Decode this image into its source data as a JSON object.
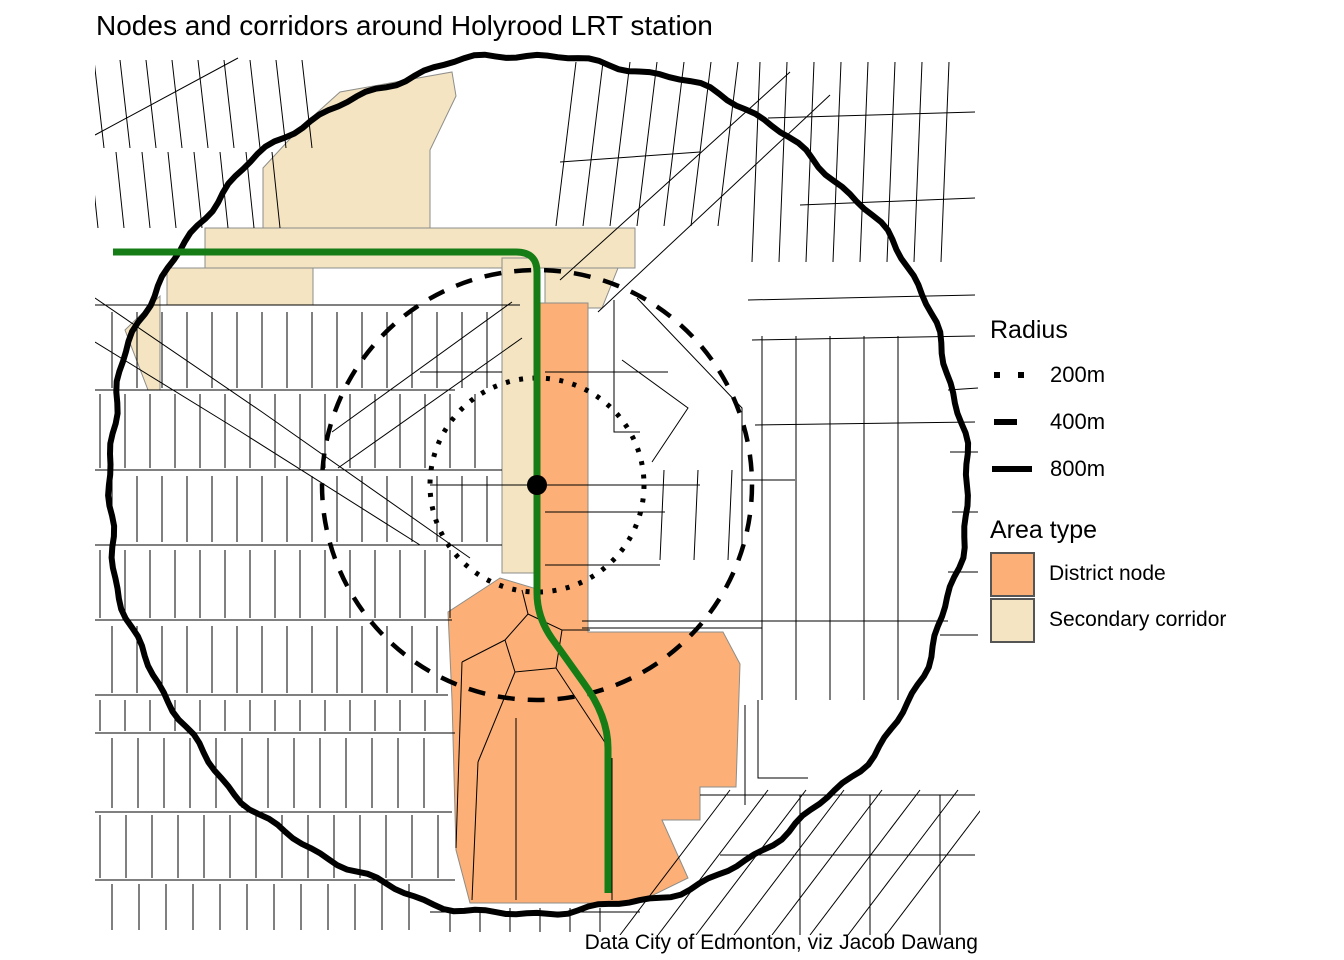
{
  "title": "Nodes and corridors around Holyrood LRT station",
  "caption": "Data City of Edmonton, viz Jacob Dawang",
  "legend_radius": {
    "title": "Radius",
    "items": [
      {
        "label": "200m",
        "style": "dotted"
      },
      {
        "label": "400m",
        "style": "dashed"
      },
      {
        "label": "800m",
        "style": "solid"
      }
    ]
  },
  "legend_area": {
    "title": "Area type",
    "items": [
      {
        "label": "District node",
        "color": "#FCAF76"
      },
      {
        "label": "Secondary corridor",
        "color": "#F4E4C2"
      }
    ]
  },
  "colors": {
    "street": "#000000",
    "district_node": "#FCAF76",
    "secondary_corridor": "#F4E4C2",
    "polygon_outline": "#8d8d89",
    "route_green": "#167D16",
    "ring_black": "#000000",
    "background": "#ffffff"
  },
  "map": {
    "extent": {
      "x": 95,
      "y": 50,
      "w": 885,
      "h": 885
    },
    "station": {
      "x": 537,
      "y": 485,
      "dot_radius": 10
    },
    "rings": [
      {
        "label": "200m",
        "r": 107,
        "style": "dotted",
        "width": 5
      },
      {
        "label": "400m",
        "r": 215,
        "style": "dashed",
        "width": 4.5
      },
      {
        "label": "800m",
        "r": 429,
        "style": "solid",
        "width": 6
      }
    ],
    "route_path": "M 113 252 L 516 252 Q 537 252 537 272 L 537 593 Q 537 618 553 640 L 583 682 Q 608 716 608 748 L 608 893",
    "route_width": 7,
    "corridor_polys": [
      [
        [
          263,
          168
        ],
        [
          300,
          128
        ],
        [
          340,
          92
        ],
        [
          452,
          72
        ],
        [
          456,
          96
        ],
        [
          430,
          150
        ],
        [
          430,
          232
        ],
        [
          263,
          232
        ]
      ],
      [
        [
          205,
          228
        ],
        [
          635,
          228
        ],
        [
          635,
          268
        ],
        [
          205,
          268
        ]
      ],
      [
        [
          167,
          268
        ],
        [
          313,
          268
        ],
        [
          313,
          305
        ],
        [
          167,
          305
        ]
      ],
      [
        [
          545,
          268
        ],
        [
          618,
          268
        ],
        [
          602,
          308
        ],
        [
          545,
          308
        ]
      ],
      [
        [
          125,
          330
        ],
        [
          160,
          296
        ],
        [
          160,
          390
        ],
        [
          148,
          390
        ]
      ],
      [
        [
          502,
          258
        ],
        [
          534,
          258
        ],
        [
          534,
          573
        ],
        [
          502,
          573
        ]
      ]
    ],
    "node_polys": [
      [
        [
          540,
          303
        ],
        [
          588,
          303
        ],
        [
          588,
          632
        ],
        [
          723,
          632
        ],
        [
          740,
          664
        ],
        [
          736,
          787
        ],
        [
          700,
          787
        ],
        [
          700,
          820
        ],
        [
          662,
          820
        ],
        [
          688,
          878
        ],
        [
          637,
          903
        ],
        [
          470,
          903
        ],
        [
          456,
          850
        ],
        [
          452,
          700
        ],
        [
          448,
          612
        ],
        [
          500,
          578
        ],
        [
          540,
          590
        ]
      ]
    ],
    "streets": {
      "lines": [
        [
          [
            95,
            305
          ],
          [
            520,
            305
          ]
        ],
        [
          [
            95,
            390
          ],
          [
            455,
            390
          ]
        ],
        [
          [
            95,
            470
          ],
          [
            502,
            470
          ]
        ],
        [
          [
            95,
            545
          ],
          [
            502,
            545
          ]
        ],
        [
          [
            95,
            620
          ],
          [
            452,
            620
          ]
        ],
        [
          [
            95,
            695
          ],
          [
            448,
            695
          ]
        ],
        [
          [
            95,
            733
          ],
          [
            455,
            733
          ]
        ],
        [
          [
            95,
            812
          ],
          [
            452,
            812
          ]
        ],
        [
          [
            95,
            880
          ],
          [
            455,
            880
          ]
        ],
        [
          [
            430,
            912
          ],
          [
            640,
            912
          ]
        ],
        [
          [
            420,
            372
          ],
          [
            502,
            372
          ]
        ],
        [
          [
            545,
            372
          ],
          [
            668,
            372
          ]
        ],
        [
          [
            430,
            485
          ],
          [
            535,
            485
          ]
        ],
        [
          [
            545,
            485
          ],
          [
            700,
            485
          ]
        ],
        [
          [
            545,
            512
          ],
          [
            665,
            512
          ]
        ],
        [
          [
            545,
            565
          ],
          [
            660,
            565
          ]
        ],
        [
          [
            582,
            621
          ],
          [
            948,
            621
          ]
        ],
        [
          [
            582,
            628
          ],
          [
            762,
            628
          ]
        ],
        [
          [
            560,
            280
          ],
          [
            790,
            72
          ]
        ],
        [
          [
            598,
            312
          ],
          [
            830,
            95
          ]
        ],
        [
          [
            332,
            432
          ],
          [
            512,
            302
          ]
        ],
        [
          [
            338,
            468
          ],
          [
            522,
            338
          ]
        ],
        [
          [
            95,
            298
          ],
          [
            262,
            412
          ],
          [
            470,
            558
          ]
        ],
        [
          [
            95,
            342
          ],
          [
            238,
            430
          ],
          [
            420,
            545
          ]
        ],
        [
          [
            238,
            58
          ],
          [
            95,
            135
          ]
        ],
        [
          [
            614,
            300
          ],
          [
            614,
            432
          ],
          [
            640,
            432
          ]
        ],
        [
          [
            622,
            360
          ],
          [
            688,
            408
          ],
          [
            652,
            462
          ]
        ],
        [
          [
            637,
            298
          ],
          [
            742,
            408
          ],
          [
            742,
            545
          ]
        ],
        [
          [
            742,
            480
          ],
          [
            795,
            480
          ]
        ],
        [
          [
            748,
            300
          ],
          [
            975,
            295
          ]
        ],
        [
          [
            752,
            340
          ],
          [
            975,
            336
          ]
        ],
        [
          [
            755,
            425
          ],
          [
            975,
            422
          ]
        ],
        [
          [
            948,
            390
          ],
          [
            978,
            388
          ]
        ],
        [
          [
            950,
            452
          ],
          [
            978,
            452
          ]
        ],
        [
          [
            952,
            512
          ],
          [
            978,
            512
          ]
        ],
        [
          [
            948,
            572
          ],
          [
            978,
            572
          ]
        ],
        [
          [
            940,
            635
          ],
          [
            978,
            635
          ]
        ],
        [
          [
            745,
            705
          ],
          [
            745,
            805
          ]
        ],
        [
          [
            758,
            700
          ],
          [
            758,
            778
          ],
          [
            808,
            778
          ]
        ],
        [
          [
            768,
            118
          ],
          [
            975,
            112
          ]
        ],
        [
          [
            800,
            205
          ],
          [
            975,
            198
          ]
        ],
        [
          [
            560,
            162
          ],
          [
            700,
            152
          ]
        ],
        [
          [
            700,
            795
          ],
          [
            975,
            795
          ]
        ],
        [
          [
            720,
            855
          ],
          [
            975,
            855
          ]
        ],
        [
          [
            800,
            795
          ],
          [
            800,
            935
          ]
        ],
        [
          [
            870,
            795
          ],
          [
            870,
            935
          ]
        ],
        [
          [
            940,
            795
          ],
          [
            940,
            935
          ]
        ],
        [
          [
            505,
            640
          ],
          [
            528,
            614
          ],
          [
            562,
            630
          ],
          [
            556,
            668
          ],
          [
            515,
            672
          ],
          [
            505,
            640
          ]
        ],
        [
          [
            505,
            640
          ],
          [
            462,
            662
          ]
        ],
        [
          [
            515,
            672
          ],
          [
            478,
            762
          ]
        ],
        [
          [
            478,
            762
          ],
          [
            472,
            900
          ]
        ],
        [
          [
            556,
            668
          ],
          [
            606,
            744
          ]
        ],
        [
          [
            528,
            614
          ],
          [
            522,
            590
          ]
        ],
        [
          [
            562,
            630
          ],
          [
            590,
            630
          ]
        ],
        [
          [
            516,
            718
          ],
          [
            516,
            900
          ]
        ],
        [
          [
            612,
            758
          ],
          [
            612,
            900
          ]
        ],
        [
          [
            462,
            662
          ],
          [
            456,
            848
          ]
        ]
      ],
      "combs": [
        {
          "x0": 104,
          "x1": 330,
          "step": 26,
          "y0": 60,
          "y1": 148,
          "skew": -10
        },
        {
          "x0": 98,
          "x1": 300,
          "step": 26,
          "y0": 152,
          "y1": 228,
          "skew": -8
        },
        {
          "x0": 112,
          "x1": 498,
          "step": 25,
          "y0": 312,
          "y1": 388,
          "skew": 0
        },
        {
          "x0": 100,
          "x1": 498,
          "step": 25,
          "y0": 394,
          "y1": 468,
          "skew": 0
        },
        {
          "x0": 112,
          "x1": 498,
          "step": 25,
          "y0": 476,
          "y1": 542,
          "skew": 0
        },
        {
          "x0": 100,
          "x1": 470,
          "step": 25,
          "y0": 550,
          "y1": 618,
          "skew": 0
        },
        {
          "x0": 112,
          "x1": 445,
          "step": 25,
          "y0": 626,
          "y1": 693,
          "skew": 0
        },
        {
          "x0": 100,
          "x1": 445,
          "step": 25,
          "y0": 700,
          "y1": 731,
          "skew": 0
        },
        {
          "x0": 112,
          "x1": 445,
          "step": 26,
          "y0": 738,
          "y1": 808,
          "skew": 0
        },
        {
          "x0": 100,
          "x1": 445,
          "step": 26,
          "y0": 815,
          "y1": 878,
          "skew": 0
        },
        {
          "x0": 112,
          "x1": 420,
          "step": 27,
          "y0": 884,
          "y1": 930,
          "skew": 0
        },
        {
          "x0": 556,
          "x1": 724,
          "step": 27,
          "y0": 62,
          "y1": 226,
          "skew": 20
        },
        {
          "x0": 752,
          "x1": 966,
          "step": 27,
          "y0": 62,
          "y1": 262,
          "skew": 8
        },
        {
          "x0": 660,
          "x1": 730,
          "step": 34,
          "y0": 470,
          "y1": 560,
          "skew": 4
        },
        {
          "x0": 762,
          "x1": 930,
          "step": 34,
          "y0": 336,
          "y1": 700,
          "skew": 0
        },
        {
          "x0": 620,
          "x1": 900,
          "step": 38,
          "y0": 790,
          "y1": 935,
          "skew": 110
        },
        {
          "x0": 450,
          "x1": 620,
          "step": 30,
          "y0": 908,
          "y1": 932,
          "skew": 0
        }
      ]
    }
  }
}
